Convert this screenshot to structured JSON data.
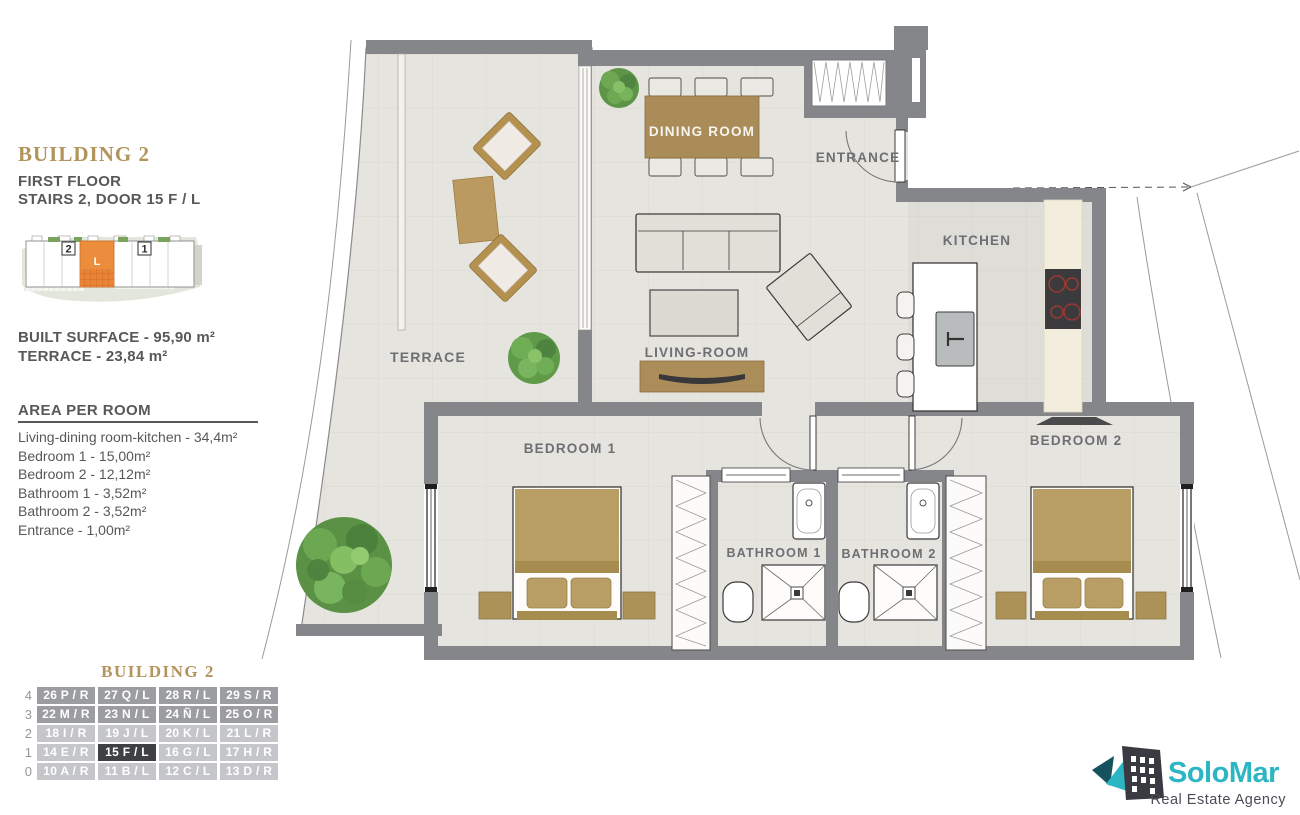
{
  "sidebar": {
    "title": "BUILDING 2",
    "floor_line": "FIRST FLOOR",
    "stairs_line": "STAIRS 2, DOOR 15 F / L",
    "inset": {
      "stairs_left": "2",
      "stairs_right": "1",
      "unit_letter": "L"
    },
    "built_surface": "BUILT SURFACE  - 95,90 m²",
    "terrace_surface": "TERRACE - 23,84 m²",
    "area_heading": "AREA PER ROOM",
    "areas": [
      "Living-dining room-kitchen - 34,4m²",
      "Bedroom 1 - 15,00m²",
      "Bedroom 2 - 12,12m²",
      "Bathroom 1 - 3,52m²",
      "Bathroom 2 - 3,52m²",
      "Entrance - 1,00m²"
    ]
  },
  "plan": {
    "labels": {
      "terrace": "TERRACE",
      "dining": "DINING ROOM",
      "entrance": "ENTRANCE",
      "kitchen": "KITCHEN",
      "living": "LIVING-ROOM",
      "bedroom1": "BEDROOM 1",
      "bedroom2": "BEDROOM 2",
      "bathroom1": "BATHROOM 1",
      "bathroom2": "BATHROOM 2"
    }
  },
  "units": {
    "title": "BUILDING 2",
    "selected_unit": "15 F / L",
    "rows": [
      {
        "floor": "4",
        "cells": [
          "26 P / R",
          "27 Q / L",
          "28 R / L",
          "29 S / R"
        ]
      },
      {
        "floor": "3",
        "cells": [
          "22 M / R",
          "23 N / L",
          "24 Ñ / L",
          "25 O / R"
        ]
      },
      {
        "floor": "2",
        "cells": [
          "18 I / R",
          "19 J / L",
          "20 K / L",
          "21 L / R"
        ]
      },
      {
        "floor": "1",
        "cells": [
          "14 E / R",
          "15 F / L",
          "16 G / L",
          "17 H / R"
        ]
      },
      {
        "floor": "0",
        "cells": [
          "10 A / R",
          "11 B / L",
          "12 C / L",
          "13 D / R"
        ]
      }
    ]
  },
  "logo": {
    "name": "SoloMar",
    "tagline": "Real Estate Agency"
  },
  "colors": {
    "accent_gold": "#b2945c",
    "highlight_orange": "#ec8d3d",
    "selected_dark": "#3f4043",
    "logo_teal": "#2cb6c4",
    "wall_gray": "#85868a"
  }
}
